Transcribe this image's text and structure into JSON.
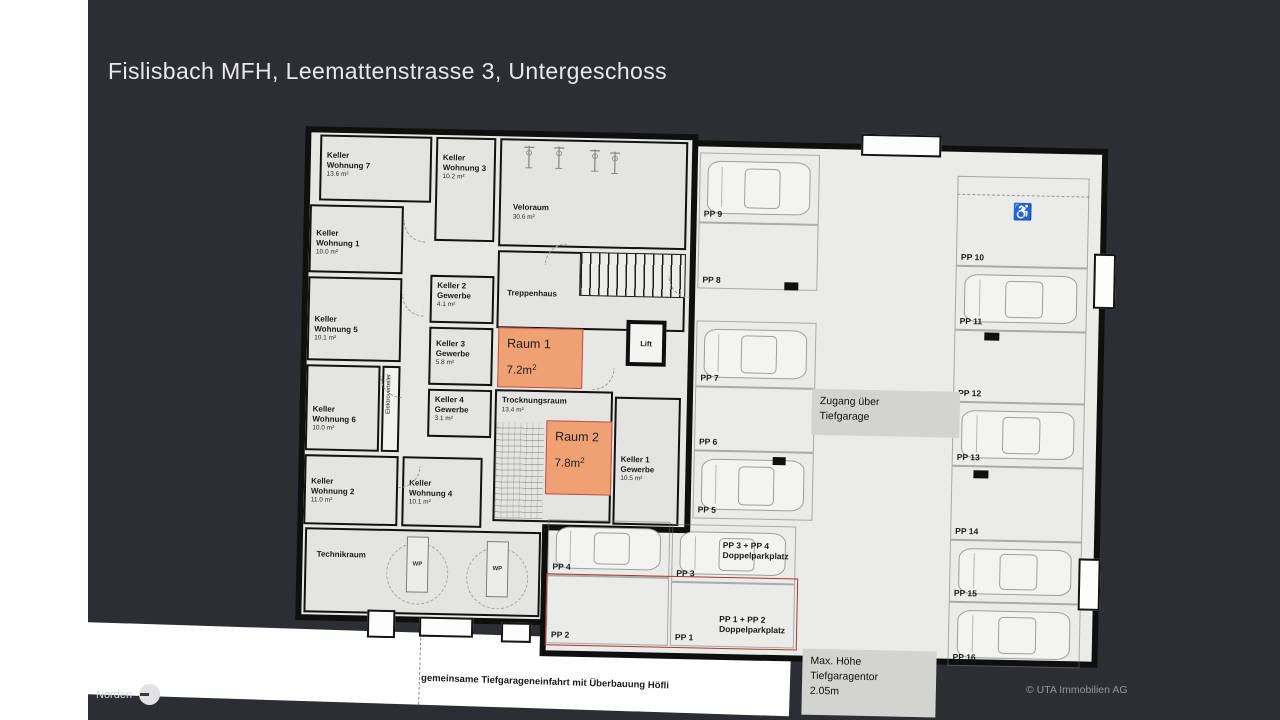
{
  "title": "Fislisbach MFH, Leemattenstrasse 3, Untergeschoss",
  "footer": {
    "north_label": "Norden",
    "ramp_label": "gemeinsame Tiefgarageneinfahrt mit Überbauung Höfli",
    "copyright": "© UTA Immobilien AG"
  },
  "colors": {
    "background": "#2d2e33",
    "building_floor": "#e7e7e5",
    "garage_floor": "#ebebe9",
    "wall": "#0f0f0f",
    "highlight_fill": "#f0a173",
    "highlight_border": "#c0504a",
    "double_park_outline": "#b23331",
    "annotation_bg": "#d3d3d1"
  },
  "rooms": {
    "kw7": {
      "name": "Keller\nWohnung 7",
      "area": "13.6 m²"
    },
    "kw3": {
      "name": "Keller\nWohnung 3",
      "area": "10.2 m²"
    },
    "veloraum": {
      "name": "Veloraum",
      "area": "30.6 m²"
    },
    "treppenhaus": {
      "name": "Treppenhaus"
    },
    "kw1": {
      "name": "Keller\nWohnung 1",
      "area": "10.0 m²"
    },
    "kw5": {
      "name": "Keller\nWohnung 5",
      "area": "10.1 m²"
    },
    "kw6": {
      "name": "Keller\nWohnung 6",
      "area": "10.0 m²"
    },
    "kw2": {
      "name": "Keller\nWohnung 2",
      "area": "11.0 m²"
    },
    "kw4": {
      "name": "Keller\nWohnung 4",
      "area": "10.1 m²"
    },
    "kg2": {
      "name": "Keller 2\nGewerbe",
      "area": "4.1 m²"
    },
    "kg3": {
      "name": "Keller 3\nGewerbe",
      "area": "5.8 m²"
    },
    "kg4": {
      "name": "Keller 4\nGewerbe",
      "area": "3.1 m²"
    },
    "kg1": {
      "name": "Keller 1\nGewerbe",
      "area": "10.5 m²"
    },
    "trocknungsraum": {
      "name": "Trocknungsraum",
      "area": "13.4 m²"
    },
    "technikraum": {
      "name": "Technikraum"
    },
    "elektroverteiler": {
      "name": "Elektroverteiler"
    },
    "lift": {
      "name": "Lift"
    },
    "wp_label": "WP"
  },
  "highlighted_rooms": {
    "raum1": {
      "name": "Raum 1",
      "area_base": "7.2m",
      "area_exp": "2"
    },
    "raum2": {
      "name": "Raum 2",
      "area_base": "7.8m",
      "area_exp": "2"
    }
  },
  "parking": {
    "pp1": {
      "label": "PP 1",
      "car": false
    },
    "pp2": {
      "label": "PP 2",
      "car": false
    },
    "pp3": {
      "label": "PP 3",
      "car": true
    },
    "pp4": {
      "label": "PP 4",
      "car": true
    },
    "pp5": {
      "label": "PP 5",
      "car": true
    },
    "pp6": {
      "label": "PP 6",
      "car": false
    },
    "pp7": {
      "label": "PP 7",
      "car": true
    },
    "pp8": {
      "label": "PP 8",
      "car": false
    },
    "pp9": {
      "label": "PP 9",
      "car": true
    },
    "pp10": {
      "label": "PP 10",
      "car": false,
      "handicap": true
    },
    "pp11": {
      "label": "PP 11",
      "car": true
    },
    "pp12": {
      "label": "PP 12",
      "car": false
    },
    "pp13": {
      "label": "PP 13",
      "car": true
    },
    "pp14": {
      "label": "PP 14",
      "car": false
    },
    "pp15": {
      "label": "PP 15",
      "car": true
    },
    "pp16": {
      "label": "PP 16",
      "car": true
    },
    "double_34": "PP 3 + PP 4\nDoppelparkplatz",
    "double_12": "PP 1 + PP 2\nDoppelparkplatz"
  },
  "annotations": {
    "zugang": "Zugang über\nTiefgarage",
    "max_hoehe": "Max. Höhe\nTiefgaragentor\n2.05m"
  }
}
